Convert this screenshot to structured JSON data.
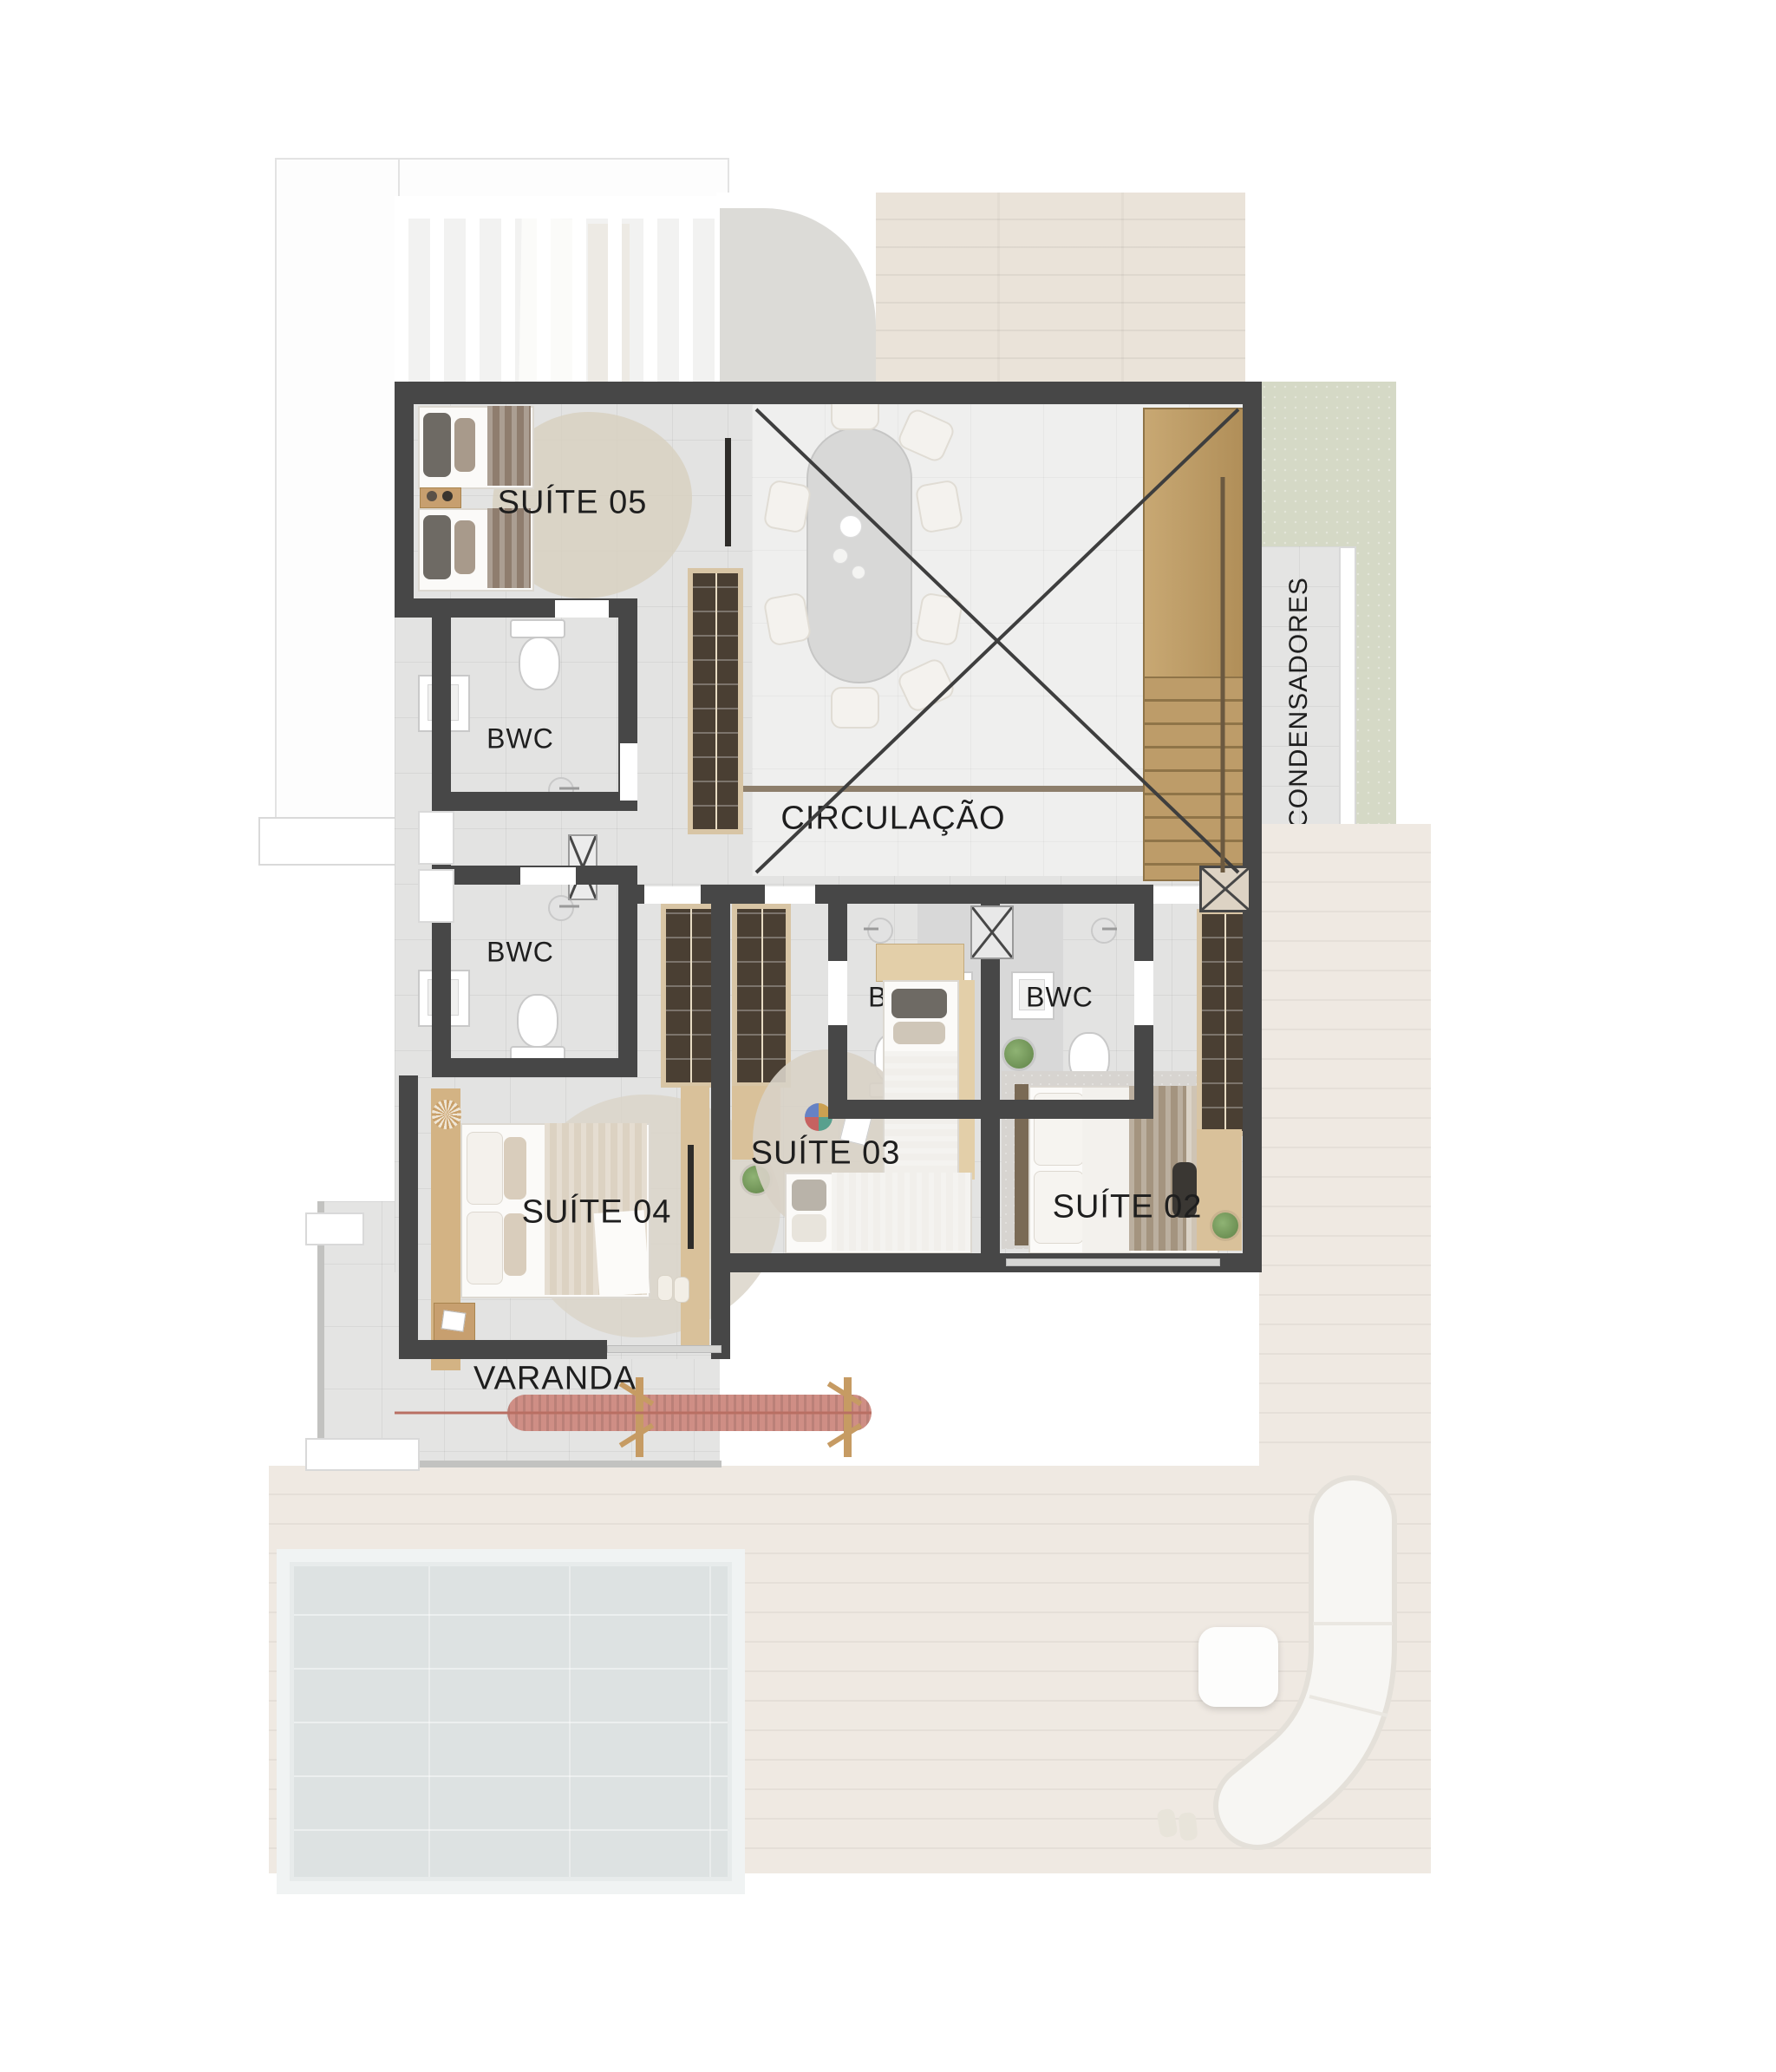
{
  "palette": {
    "wall": "#474747",
    "floor": "#e3e3e2",
    "floor_void": "#efefee",
    "deck": "#efe9e2",
    "deck_top": "#eae3d9",
    "grass": "#d5d9c6",
    "concrete": "#dcdbd7",
    "water": "#dde2e2",
    "stair_wood": "#c2a26d",
    "furniture_wood": "#d9c19a",
    "wardrobe_interior": "#4a3f33",
    "hammock_accent": "#cf8e85",
    "label_color": "#1e1e1e"
  },
  "rooms": [
    {
      "id": "suite-05",
      "label": "SUÍTE 05"
    },
    {
      "id": "bwc-suite-05",
      "label": "BWC"
    },
    {
      "id": "bwc-suite-04",
      "label": "BWC"
    },
    {
      "id": "circulacao",
      "label": "CIRCULAÇÃO"
    },
    {
      "id": "condensadores",
      "label": "CONDENSADORES"
    },
    {
      "id": "bwc-suite-03",
      "label": "BWC"
    },
    {
      "id": "bwc-suite-02",
      "label": "BWC"
    },
    {
      "id": "suite-04",
      "label": "SUÍTE 04"
    },
    {
      "id": "suite-03",
      "label": "SUÍTE 03"
    },
    {
      "id": "suite-02",
      "label": "SUÍTE 02"
    },
    {
      "id": "varanda",
      "label": "VARANDA"
    }
  ],
  "features": [
    "pergola-roof",
    "double-height-void",
    "staircase",
    "dining-table",
    "pool",
    "hammock",
    "outdoor-lounge",
    "condenser-yard"
  ]
}
